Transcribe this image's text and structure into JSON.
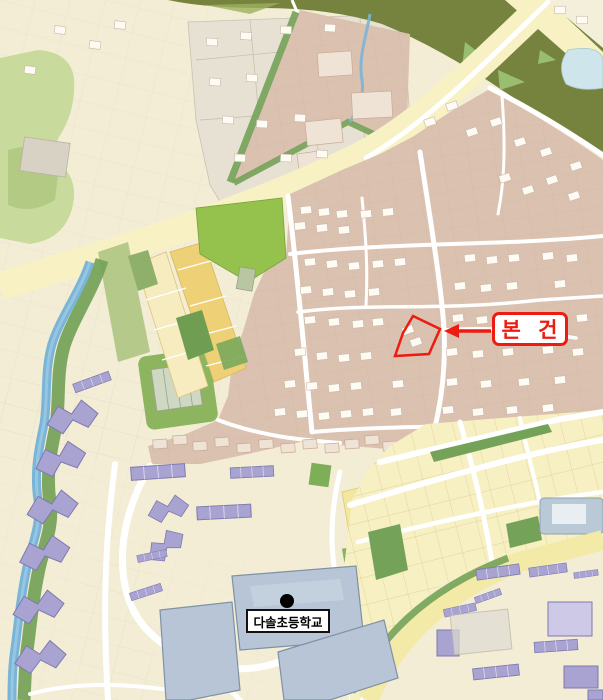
{
  "map": {
    "annotation": {
      "label": "본 건"
    },
    "school": {
      "label": "다솔초등학교"
    }
  },
  "palette": {
    "cream": "#f3edd6",
    "parcel-line": "#dcd2b6",
    "gray-parcel": "#e7e1d3",
    "brown": "#dbc1af",
    "brown-line": "#c9ab97",
    "dark-band": "#75833f",
    "band-light": "#9cb05e",
    "bright-green": "#94c24c",
    "mid-green": "#74a258",
    "light-green": "#c8db9d",
    "stream": "#7ab5d8",
    "road-yellow": "#f7f1c4",
    "gold": "#eed077",
    "pale-gold": "#f6ecc0",
    "purple": "#a9a3d2",
    "purple-line": "#7e79af",
    "school-blue": "#b7c5d6",
    "school-line": "#8091a5",
    "pond": "#cfe5ec",
    "grid-yellow": "#f6f0c2",
    "grid-line": "#ddbe86",
    "red": "#ec1c12",
    "black": "#111111"
  }
}
